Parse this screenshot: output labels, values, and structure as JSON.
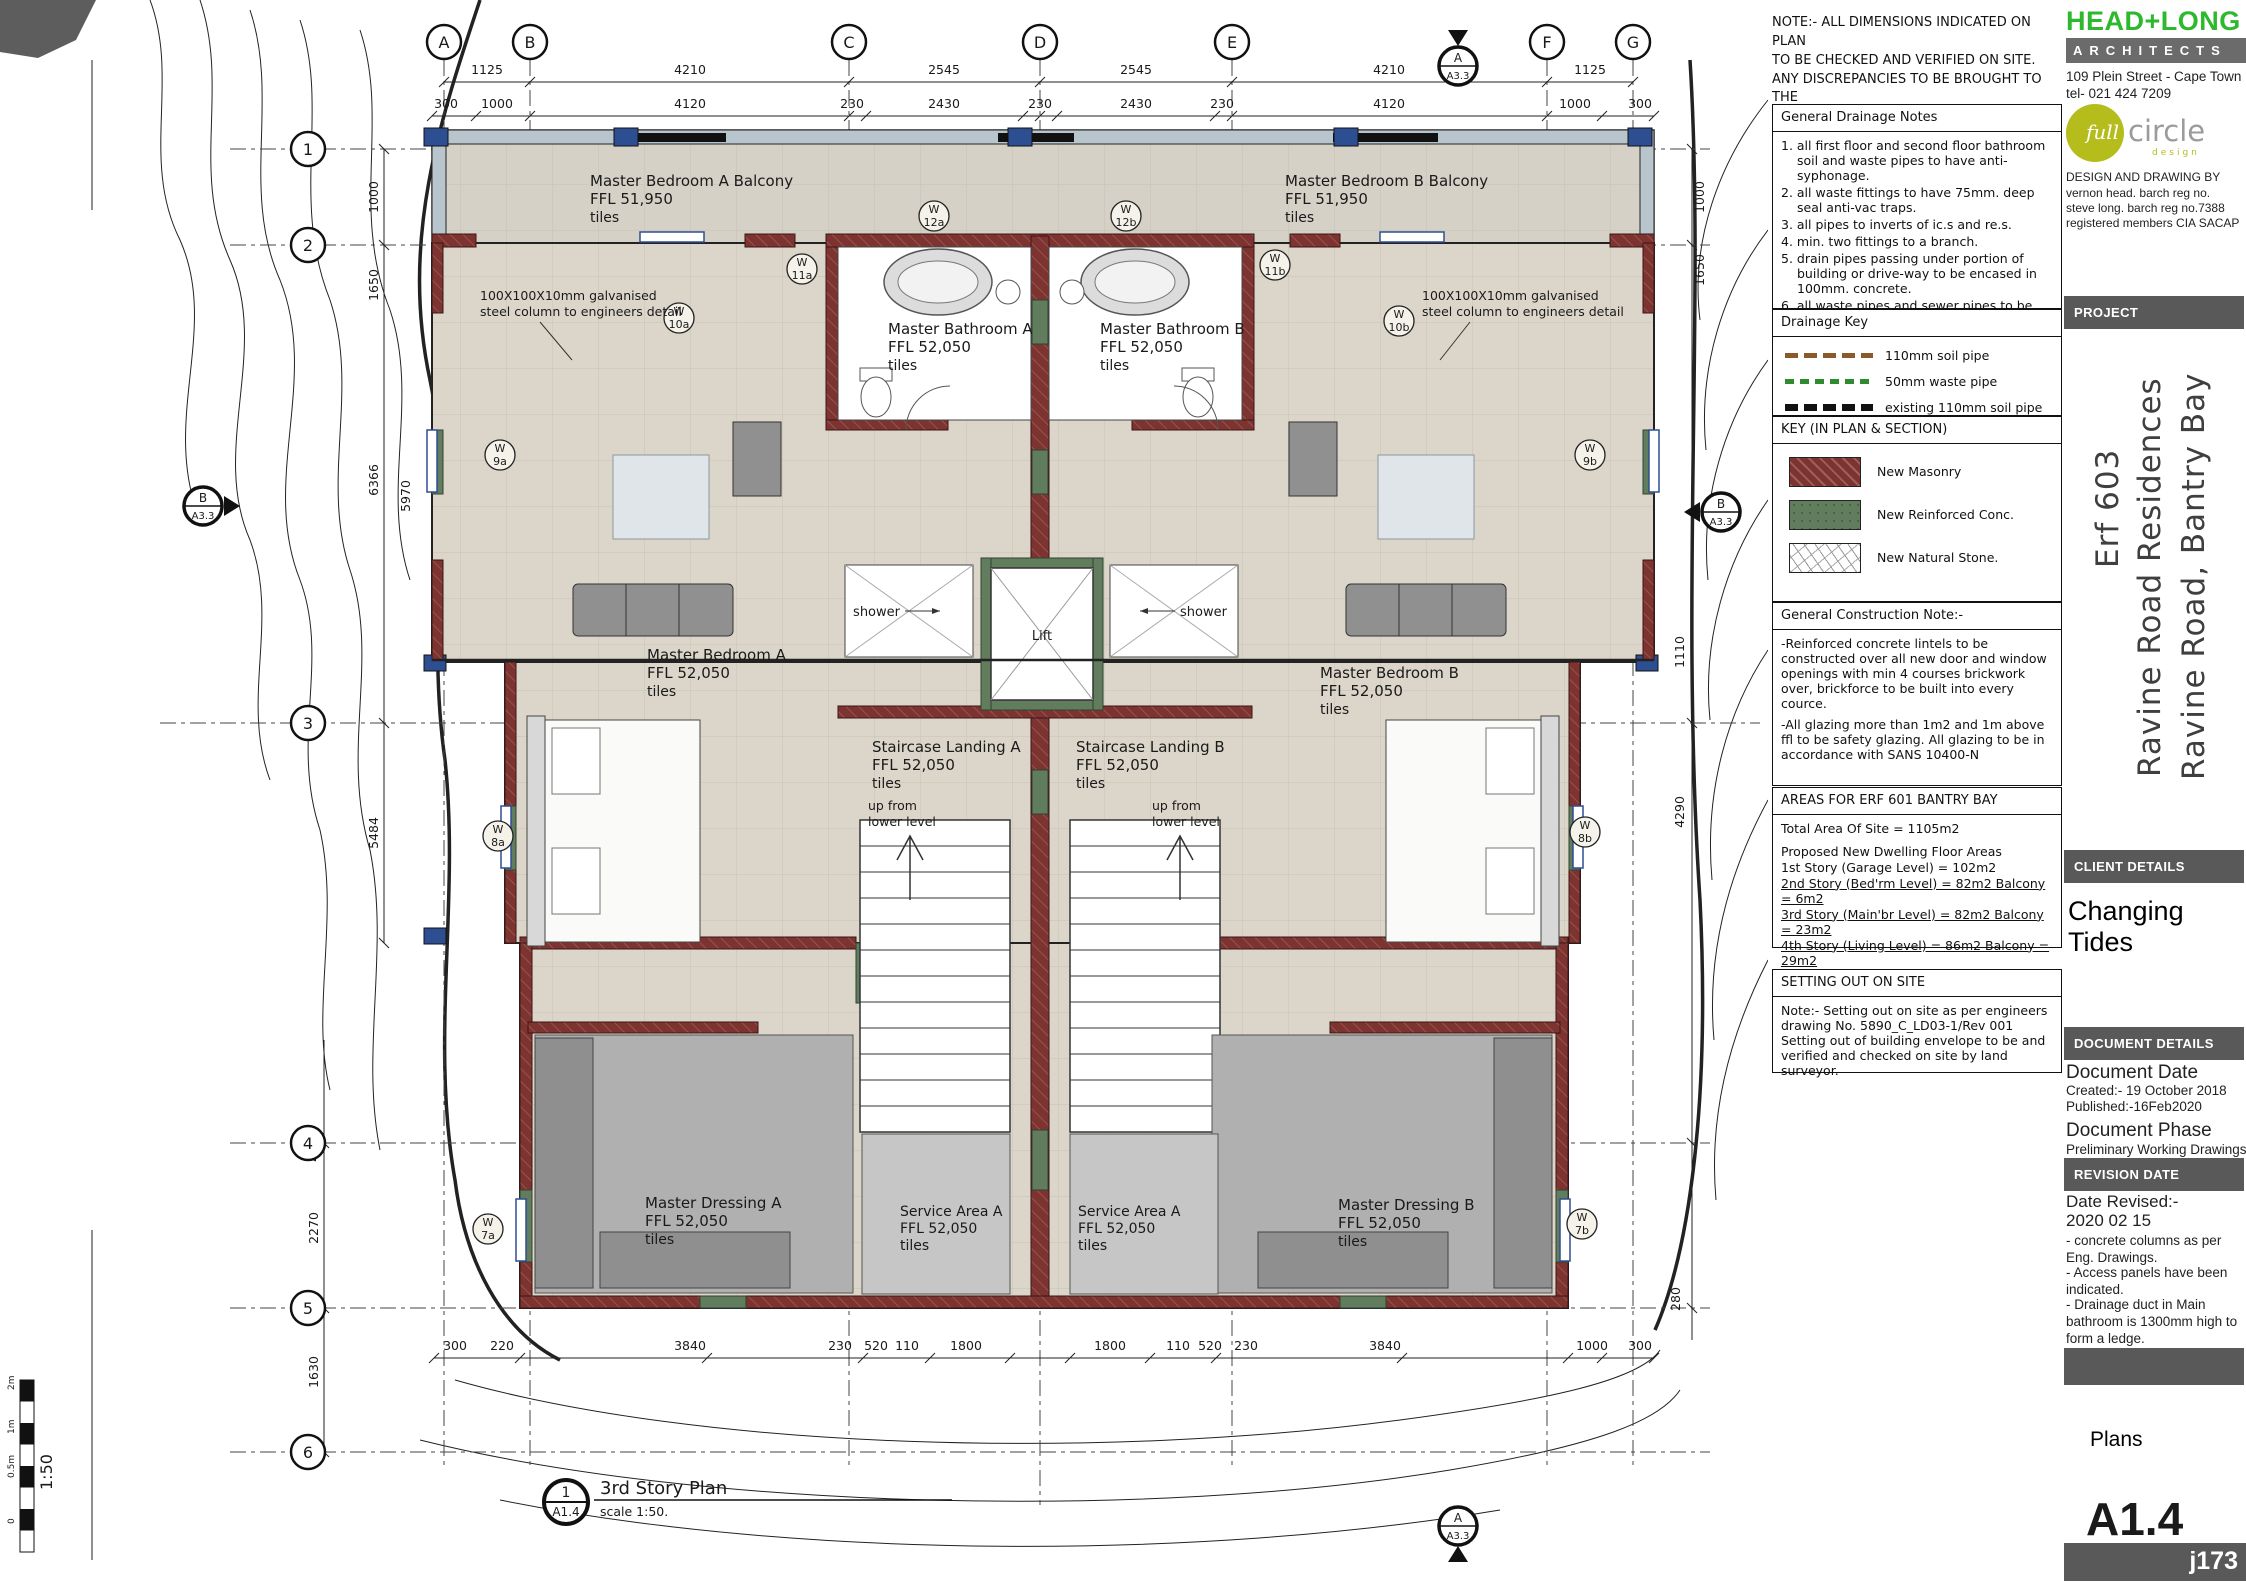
{
  "sheet_note": {
    "lines": [
      "NOTE:- ALL DIMENSIONS INDICATED ON PLAN",
      "TO BE CHECKED AND VERIFIED ON SITE.",
      "ANY DISCREPANCIES TO BE BROUGHT TO THE",
      "ARCHITECTS ATTENTION IMMEDIATELY."
    ]
  },
  "drainage_notes": {
    "title": "General Drainage Notes",
    "items": [
      "1. all first floor and second floor bathroom soil and waste pipes to have anti-syphonage.",
      "2. all waste fittings to have 75mm. deep seal anti-vac traps.",
      "3. all pipes to inverts of ic.s and re.s.",
      "4. min. two fittings to a branch.",
      "5. drain pipes passing under portion of building or drive-way to be encased in 100mm. concrete.",
      "6. all waste pipes and sewer pipes to be fully accessable for inspection repairs.",
      "7. plumbing to be installed and checked by a qualified plumber."
    ]
  },
  "drainage_key": {
    "title": "Drainage Key",
    "items": [
      {
        "label": "110mm soil pipe",
        "color": "#8a5a2a"
      },
      {
        "label": "50mm waste pipe",
        "color": "#2e8b2e"
      },
      {
        "label": "existing 110mm soil pipe",
        "color": "#111111"
      }
    ]
  },
  "plan_key": {
    "title": "KEY (IN PLAN & SECTION)",
    "items": [
      {
        "label": "New Masonry",
        "color": "#7d3431"
      },
      {
        "label": "New Reinforced Conc.",
        "color": "#617d5e"
      },
      {
        "label": "New Natural Stone.",
        "color": "#ffffff"
      }
    ]
  },
  "construction_note": {
    "title": "General Construction Note:-",
    "paras": [
      "-Reinforced concrete lintels to be constructed over all new door and window openings with min 4 courses brickwork over, brickforce to be built into every cource.",
      "-All glazing more than 1m2 and 1m above ffl to be safety glazing. All glazing to be in accordance with SANS 10400-N"
    ]
  },
  "areas": {
    "title": "AREAS FOR ERF 601 BANTRY BAY",
    "site_line": "Total Area Of Site = 1105m2",
    "heading": "Proposed New Dwelling Floor Areas",
    "lines": [
      {
        "text": "1st Story (Garage Level) = 102m2"
      },
      {
        "text": "2nd Story (Bed'rm Level) = 82m2 Balcony = 6m2"
      },
      {
        "text": "3rd Story (Main'br Level) = 82m2 Balcony = 23m2"
      },
      {
        "text": "4th Story (Living Level)  = 86m2 Balcony = 29m2"
      },
      {
        "text": "Total area - internal = 352m2 Balcony = 58m2"
      }
    ]
  },
  "setting_out": {
    "title": "SETTING OUT ON SITE",
    "lines": [
      "Note:- Setting out on site as per engineers",
      "drawing No. 5890_C_LD03-1/Rev 001",
      "Setting out of building envelope to be and",
      "verified and checked on site by land surveyor."
    ]
  },
  "titleblock": {
    "firm": "HEAD+LONG",
    "firm_sub": "ARCHITECTS",
    "address": "109 Plein Street  -  Cape Town",
    "tel": "tel- 021 424 7209",
    "logo_full": "full",
    "logo_circle": "circle",
    "logo_design": "design",
    "credit_title": "DESIGN AND DRAWING BY",
    "credits": [
      "vernon head. barch reg no.",
      "steve long. barch reg no.7388",
      "registered members CIA SACAP"
    ],
    "project_label": "PROJECT",
    "project_lines": [
      "Erf 603",
      "Ravine Road Residences",
      "Ravine Road, Bantry Bay"
    ],
    "client_label": "CLIENT DETAILS",
    "client": "Changing Tides",
    "document_label": "DOCUMENT DETAILS",
    "doc_date_h": "Document Date",
    "doc_created": "Created:- 19 October 2018",
    "doc_published": "Published:-16Feb2020",
    "doc_phase_h": "Document Phase",
    "doc_phase": "Preliminary Working Drawings",
    "revision_label": "REVISION DATE",
    "rev_h": "Date Revised:-",
    "rev_date": "2020 02 15",
    "rev_notes": [
      "- concrete columns as per Eng. Drawings.",
      "- Access panels have been indicated.",
      "- Drainage duct in Main bathroom is 1300mm high to form a ledge."
    ],
    "sheet_name": "Plans",
    "sheet_no": "A1.4",
    "job_no": "j173"
  },
  "plan": {
    "title": "3rd Story Plan",
    "title_ref_top": "1",
    "title_ref_bottom": "A1.4",
    "scale_text": "scale 1:50.",
    "scalebar": {
      "label": "1:50",
      "ticks": [
        "2m",
        "1m",
        "0.5m",
        "0"
      ]
    },
    "grid_cols": [
      "A",
      "B",
      "C",
      "D",
      "E",
      "F",
      "G"
    ],
    "grid_rows": [
      "1",
      "2",
      "3",
      "4",
      "5",
      "6"
    ],
    "sections": {
      "a": "A",
      "b": "B",
      "ref": "A3.3"
    },
    "dims_top": [
      "1125",
      "4210",
      "2545",
      "2545",
      "4210",
      "1125"
    ],
    "dims_top2": [
      "300",
      "1000",
      "4120",
      "230",
      "2430",
      "230",
      "2430",
      "230",
      "4120",
      "1000",
      "300"
    ],
    "dims_left": [
      "1000",
      "1650",
      "6366",
      "5970",
      "5484"
    ],
    "dims_left2": [
      "4020",
      "2270",
      "1630"
    ],
    "dims_right": [
      "1000",
      "1650",
      "1110",
      "4290",
      "280"
    ],
    "dims_bottom": [
      "300",
      "220",
      "3840",
      "230",
      "520",
      "110",
      "1800",
      "1800",
      "110",
      "520",
      "230",
      "3840",
      "1000",
      "300"
    ],
    "window_prefix": "W",
    "windows": [
      "12a",
      "12b",
      "11a",
      "11b",
      "10a",
      "10b",
      "9a",
      "9b",
      "8a",
      "8b",
      "7a",
      "7b"
    ],
    "rooms": [
      {
        "name": "Master Bedroom A Balcony",
        "ffl": "FFL 51,950",
        "fin": "tiles"
      },
      {
        "name": "Master Bedroom B Balcony",
        "ffl": "FFL 51,950",
        "fin": "tiles"
      },
      {
        "name": "Master Bathroom A",
        "ffl": "FFL 52,050",
        "fin": "tiles"
      },
      {
        "name": "Master Bathroom B",
        "ffl": "FFL 52,050",
        "fin": "tiles"
      },
      {
        "name": "Master Bedroom A",
        "ffl": "FFL 52,050",
        "fin": "tiles"
      },
      {
        "name": "Master Bedroom B",
        "ffl": "FFL 52,050",
        "fin": "tiles"
      },
      {
        "name": "Staircase Landing A",
        "ffl": "FFL 52,050",
        "fin": "tiles"
      },
      {
        "name": "Staircase Landing B",
        "ffl": "FFL 52,050",
        "fin": "tiles"
      },
      {
        "name": "Master Dressing A",
        "ffl": "FFL 52,050",
        "fin": "tiles"
      },
      {
        "name": "Master Dressing B",
        "ffl": "FFL 52,050",
        "fin": "tiles"
      },
      {
        "name": "Service Area A",
        "ffl": "FFL 52,050",
        "fin": "tiles"
      },
      {
        "name": "Service Area A",
        "ffl": "FFL 52,050",
        "fin": "tiles"
      }
    ],
    "labels": {
      "lift": "Lift",
      "shower": "shower",
      "up1": "up from",
      "up2": "lower level",
      "steel1": "100X100X10mm galvanised",
      "steel2": "steel column to engineers detail"
    }
  }
}
